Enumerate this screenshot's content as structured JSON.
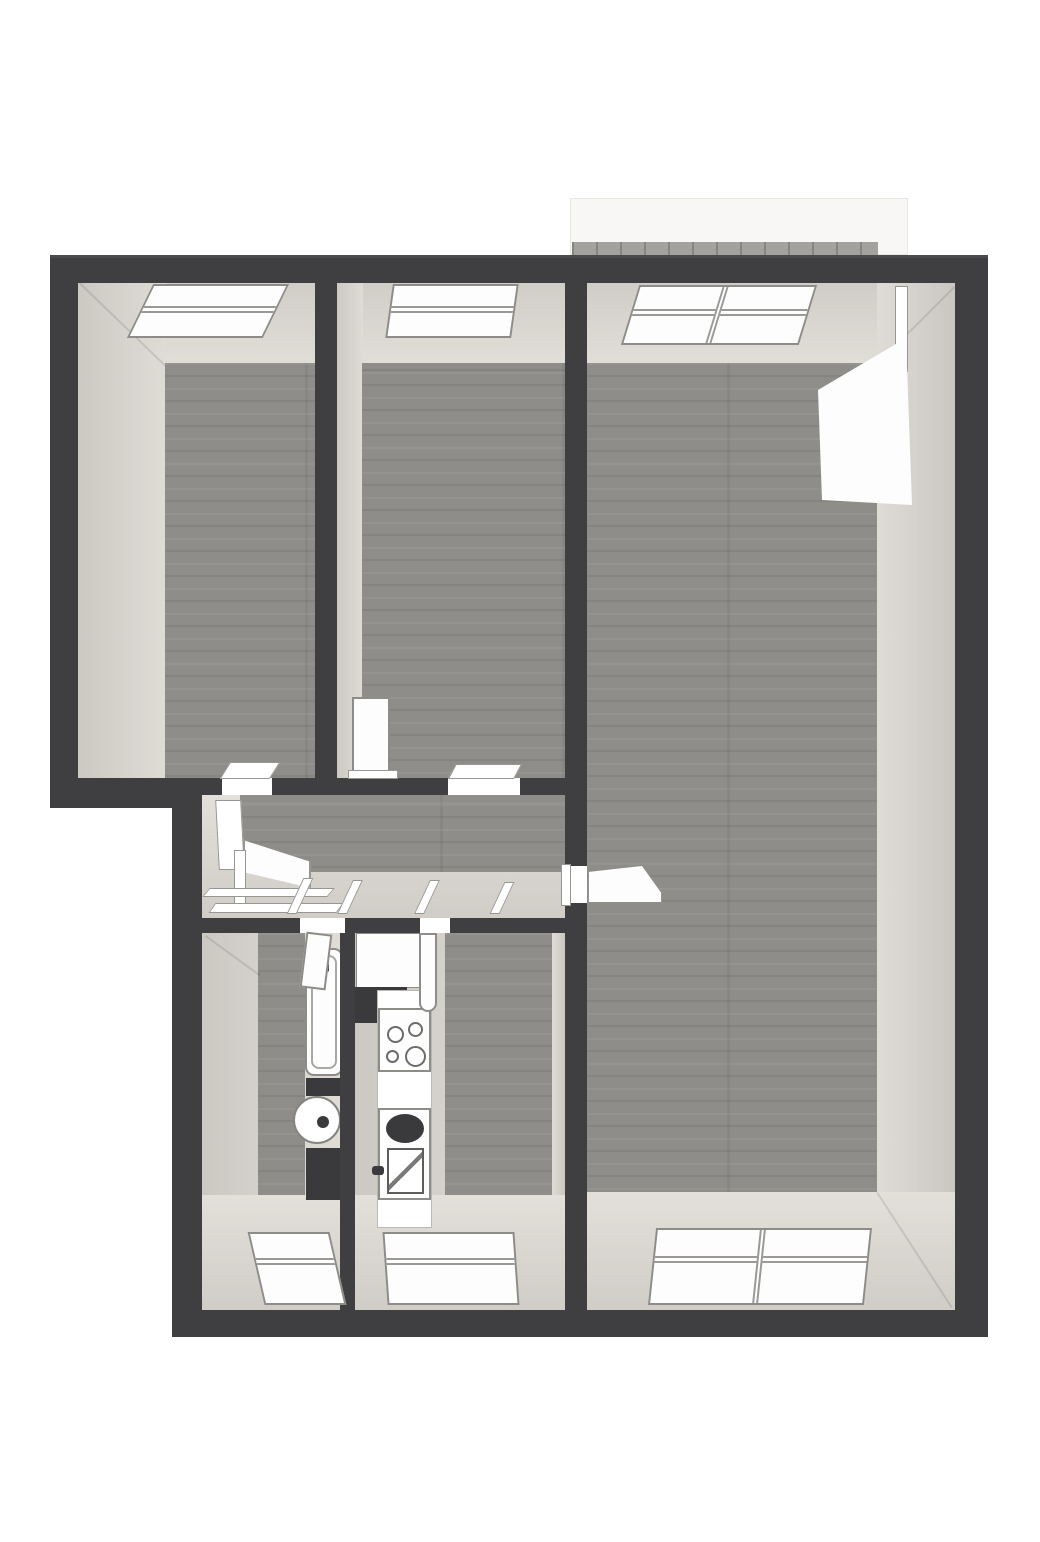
{
  "scene": {
    "kind": "3d-floor-plan-render-top-down",
    "background": "#ffffff",
    "no_visible_text": true
  },
  "palette": {
    "bg": "#ffffff",
    "wall": "#3f3f42",
    "face": "#d8d6cf",
    "wood": "#8e8d89",
    "fixture": "#fdfdfd",
    "line": "#8d8c88",
    "darkfix": "#3a3a3c",
    "brick": "#a3a29e",
    "balcony": "#f8f7f5"
  },
  "rooms": [
    {
      "name": "bedroom-top-left",
      "floor": "wood",
      "openings": [
        "top-window",
        "door-to-hallway"
      ]
    },
    {
      "name": "bedroom-top-middle",
      "floor": "wood",
      "openings": [
        "top-window",
        "door-to-hallway"
      ],
      "fixtures": [
        "open-door-leaf"
      ]
    },
    {
      "name": "living-room",
      "floor": "wood",
      "openings": [
        "top-window",
        "balcony-door",
        "bottom-window",
        "door-to-hallway"
      ]
    },
    {
      "name": "hallway",
      "floor": "wood",
      "openings": [
        "entry-door",
        "door-to-bathroom",
        "door-to-kitchen",
        "door-to-living-room"
      ]
    },
    {
      "name": "bathroom",
      "floor": "wood",
      "openings": [
        "bottom-window",
        "door-to-hallway"
      ],
      "fixtures": [
        "bathtub",
        "washbasin",
        "dark-cabinet",
        "dark-shelf"
      ]
    },
    {
      "name": "kitchen",
      "floor": "wood",
      "openings": [
        "bottom-window",
        "door-to-hallway"
      ],
      "fixtures": [
        "refrigerator",
        "duct-block",
        "counter",
        "cooktop-4-burners",
        "sink-with-drainer"
      ]
    },
    {
      "name": "balcony",
      "floor": "tile",
      "position": "top-right-outside"
    }
  ],
  "windows": [
    {
      "room": "bedroom-top-left",
      "side": "top",
      "panes": 2
    },
    {
      "room": "bedroom-top-middle",
      "side": "top",
      "panes": 2
    },
    {
      "room": "living-room",
      "side": "top",
      "panes": 3
    },
    {
      "room": "living-room",
      "side": "bottom",
      "panes": 2
    },
    {
      "room": "bathroom",
      "side": "bottom",
      "panes": 1
    },
    {
      "room": "kitchen",
      "side": "bottom",
      "panes": 1
    }
  ],
  "doors": [
    {
      "name": "entry-door",
      "state": "open",
      "location": "hallway-left"
    },
    {
      "name": "bedroom-top-left-door",
      "state": "open",
      "location": "bottom-wall"
    },
    {
      "name": "bedroom-top-middle-door",
      "state": "open-parked-against-wall",
      "location": "bottom-wall"
    },
    {
      "name": "bathroom-door",
      "state": "open",
      "location": "top-wall"
    },
    {
      "name": "kitchen-door",
      "state": "open",
      "location": "top-wall"
    },
    {
      "name": "living-room-door",
      "state": "opening-with-threshold",
      "location": "left-wall"
    },
    {
      "name": "balcony-door",
      "state": "open",
      "location": "living-room-top"
    }
  ]
}
